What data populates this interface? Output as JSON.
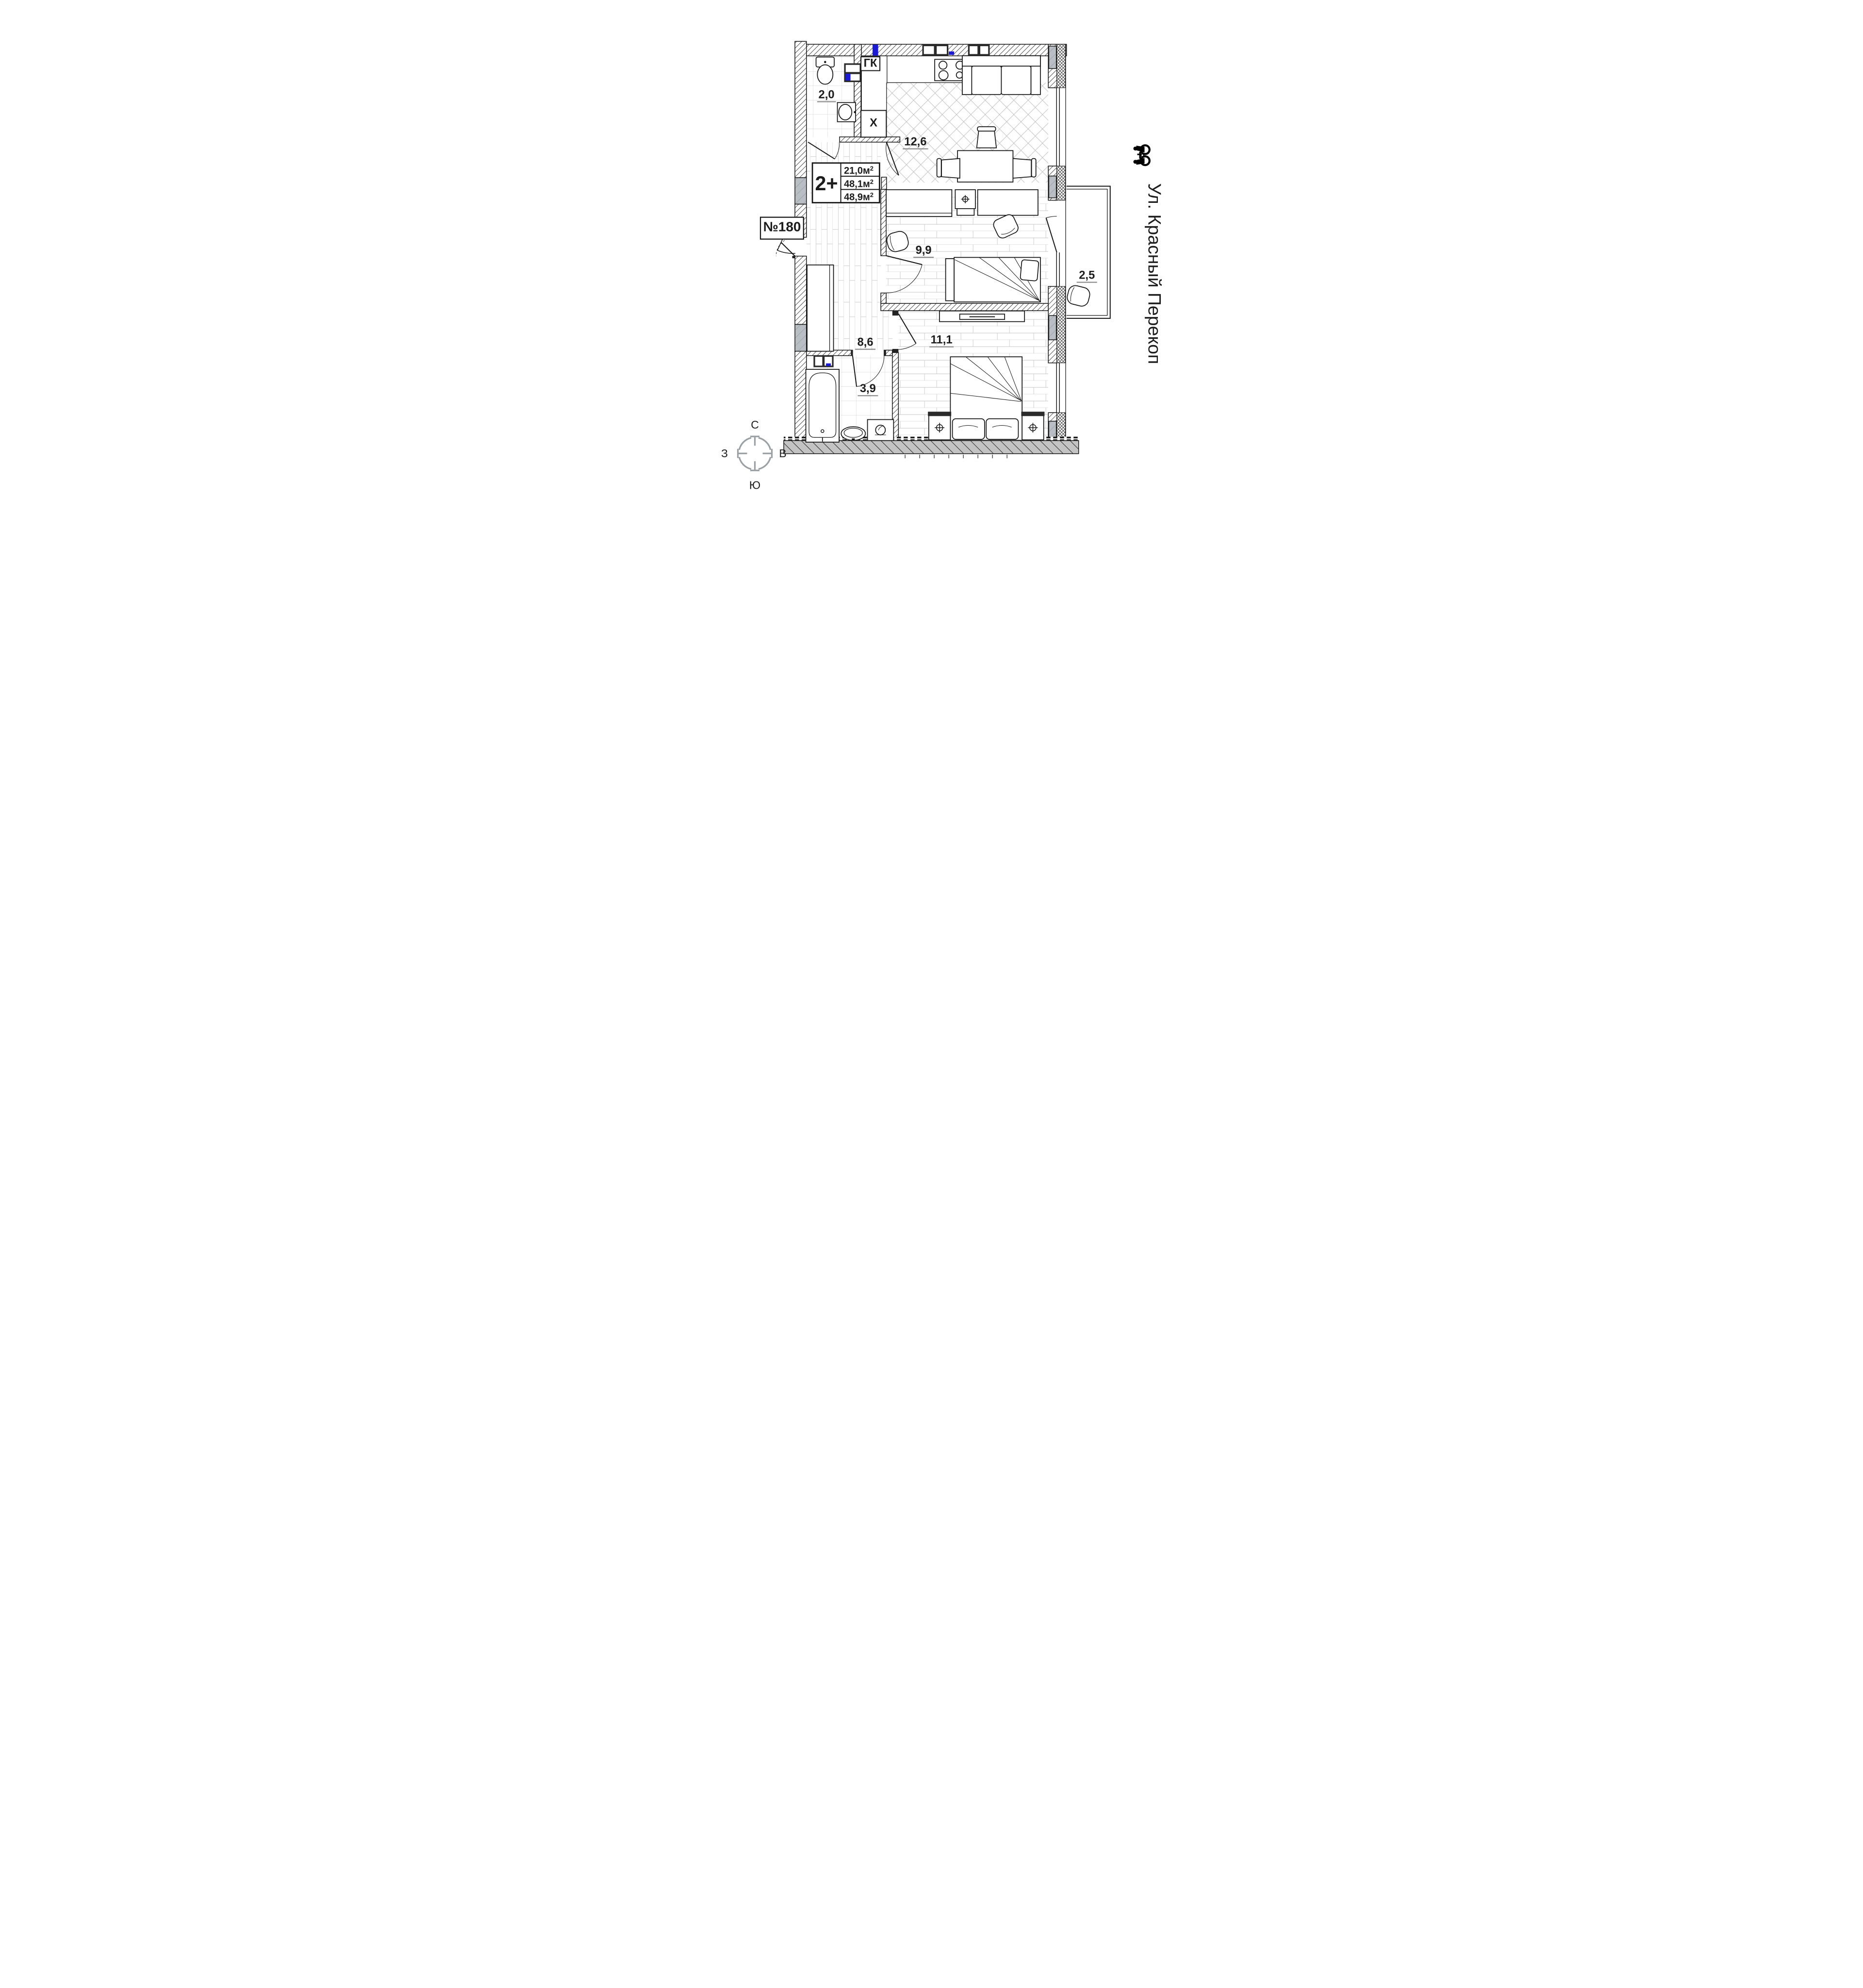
{
  "unit": {
    "number": "№180",
    "type": "2+",
    "areas": {
      "living": "21,0",
      "usable": "48,1",
      "total": "48,9"
    },
    "area_unit": "м",
    "area_sup": "2"
  },
  "street": "Ул. Красный Перекоп",
  "rooms": {
    "wc": "2,0",
    "kitchen_living": "12,6",
    "bedroom": "9,9",
    "hallway": "8,6",
    "bathroom": "3,9",
    "bedroom_master": "11,1",
    "balcony": "2,5"
  },
  "marks": {
    "wardrobe_closet": "ГК",
    "fridge": "Х"
  },
  "compass": {
    "north": "С",
    "south": "Ю",
    "west": "З",
    "east": "В"
  },
  "colors": {
    "wall_glass_gray": "#b9bec4",
    "bottom_wall_gray": "#c3c3c3",
    "plumbing_blue": "#1b1bd1",
    "floor_grid_gray": "#c7c7c7",
    "compass_gray": "#9aa0a4"
  }
}
